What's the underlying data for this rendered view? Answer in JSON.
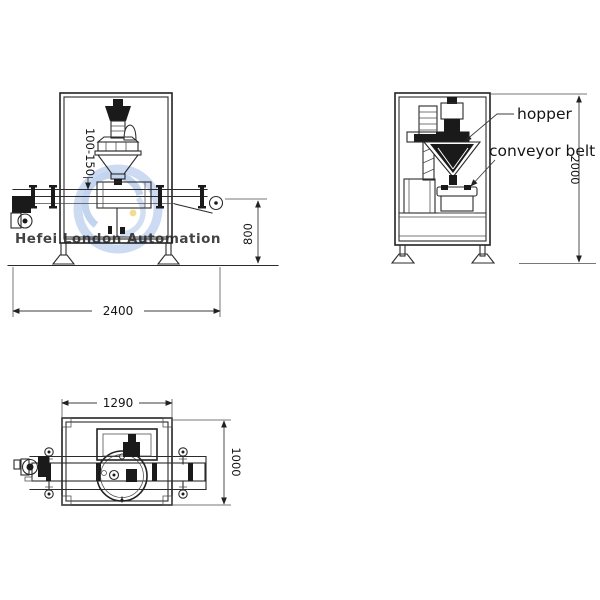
{
  "watermark": {
    "text": "Hefei London Automation",
    "color": "#a9c5e7"
  },
  "front_view": {
    "dim_container_height": "100-150",
    "dim_belt_height": "800",
    "dim_overall_length": "2400"
  },
  "side_view": {
    "hopper_label": "hopper",
    "conveyor_label": "conveyor belt",
    "dim_overall_height": "2000"
  },
  "top_view": {
    "dim_width": "1290",
    "dim_depth": "1000"
  },
  "colors": {
    "line": "#2b2b2b",
    "dark_fill": "#1a1a1a",
    "watermark_blue": "#b9cdea",
    "logo_accent_yellow": "#ecc94f"
  }
}
